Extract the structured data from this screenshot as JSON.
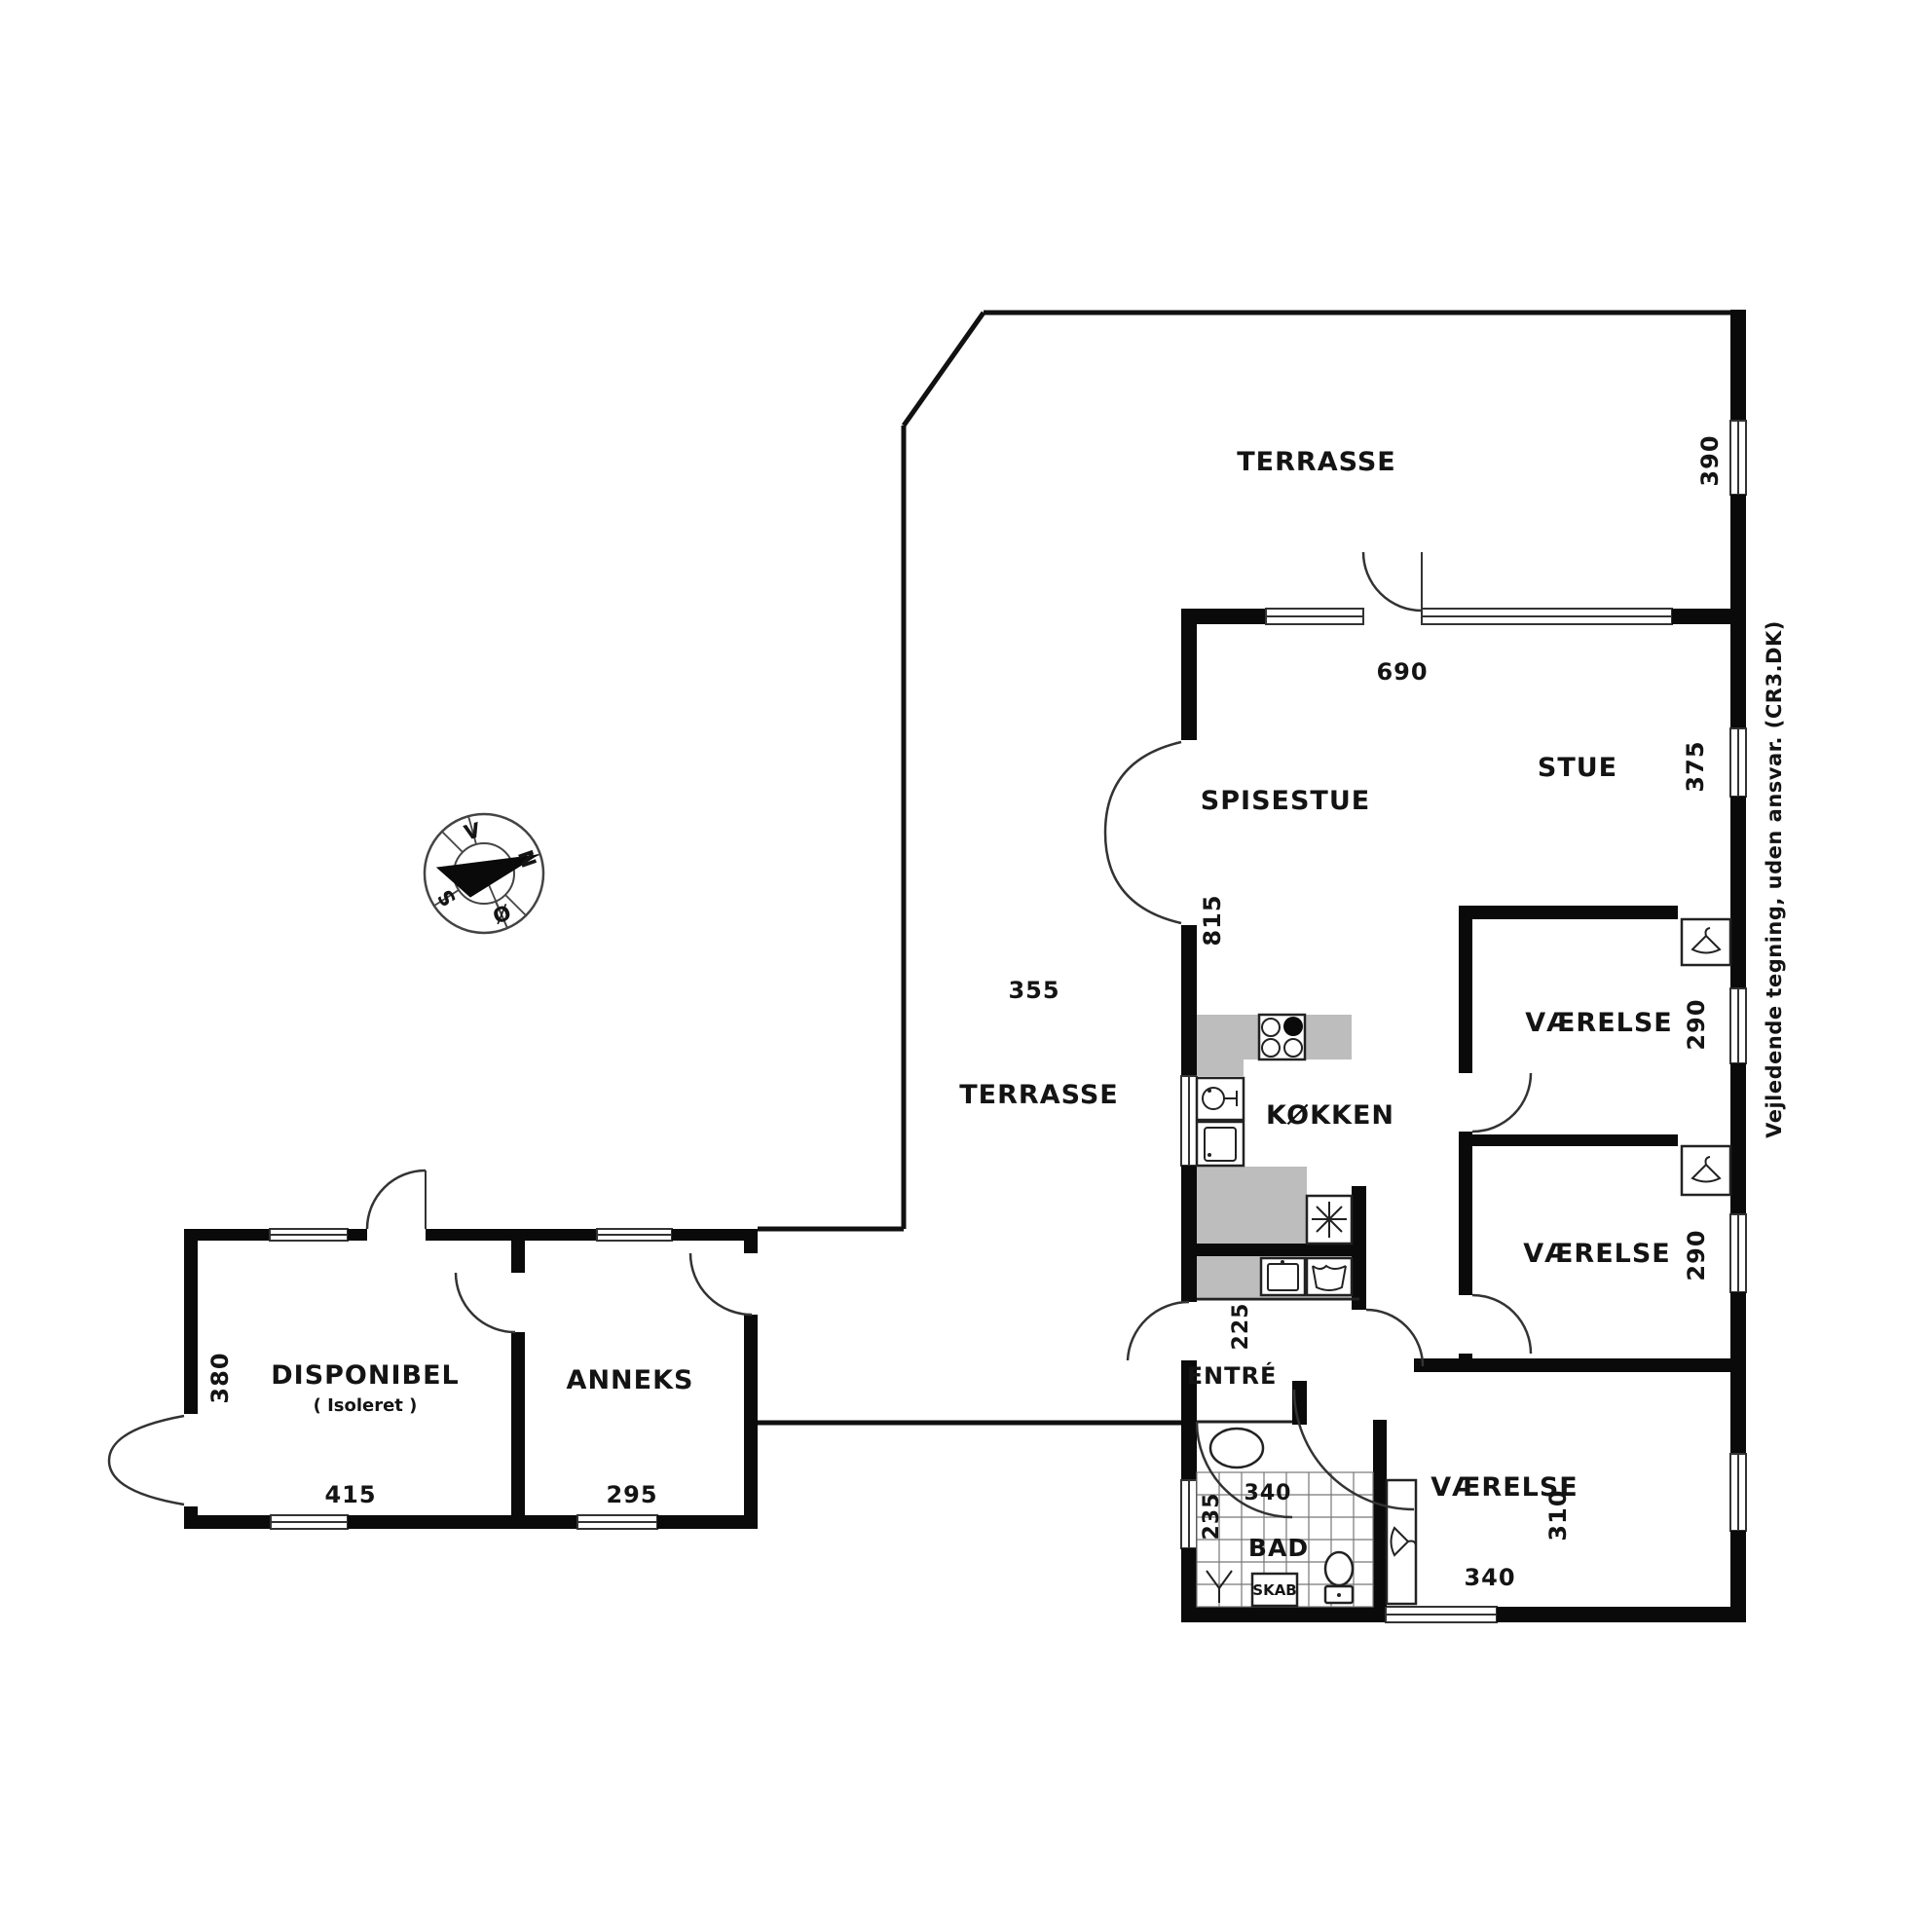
{
  "plan": {
    "rooms": {
      "terrasse_upper": {
        "label": "TERRASSE",
        "dim_side": "390"
      },
      "terrasse_lower": {
        "label": "TERRASSE",
        "dim_top": "355"
      },
      "stue": {
        "label": "STUE",
        "dim_side": "375",
        "dim_top": "690"
      },
      "spisestue": {
        "label": "SPISESTUE",
        "dim_side": "815"
      },
      "kokken": {
        "label": "KØKKEN"
      },
      "vaerelse1": {
        "label": "VÆRELSE",
        "dim_side": "290"
      },
      "vaerelse2": {
        "label": "VÆRELSE",
        "dim_side": "290"
      },
      "vaerelse3": {
        "label": "VÆRELSE",
        "dim_side": "310",
        "dim_bottom": "340"
      },
      "entre": {
        "label": "ENTRÉ",
        "dim": "225"
      },
      "bad": {
        "label": "BAD",
        "dim_width": "340",
        "dim_depth": "235",
        "closet": "SKAB"
      },
      "disponibel": {
        "label": "DISPONIBEL",
        "note": "( Isoleret )",
        "dim_side": "380",
        "dim_bottom": "415"
      },
      "anneks": {
        "label": "ANNEKS",
        "dim_bottom": "295"
      }
    },
    "compass": {
      "n": "N",
      "east": "Ø",
      "s": "S",
      "w": "V"
    },
    "disclaimer": "Vejledende tegning, uden ansvar. (CR3.DK)"
  }
}
